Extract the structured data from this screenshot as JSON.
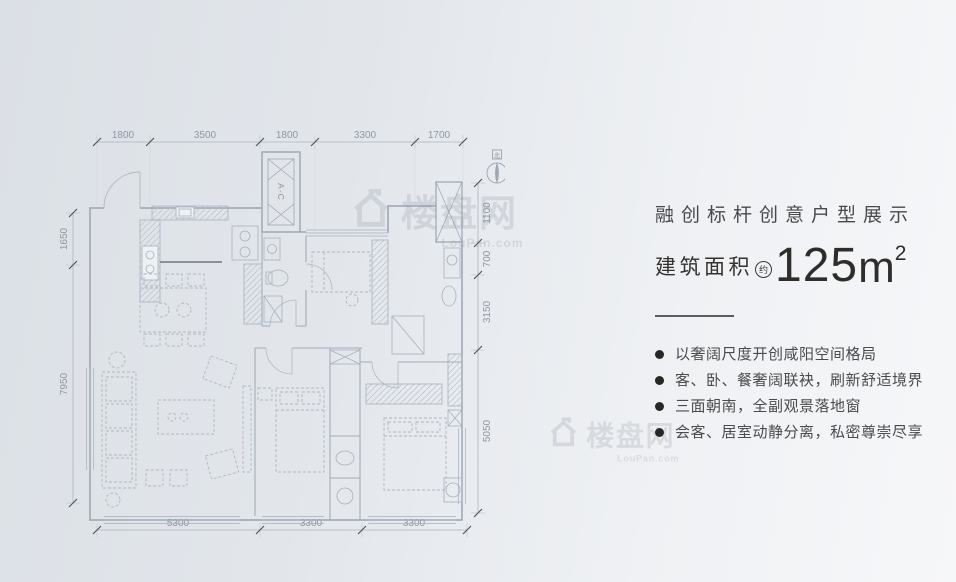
{
  "floorplan": {
    "dims": {
      "top": [
        "1800",
        "3500",
        "1800",
        "3300",
        "1700"
      ],
      "bottom": [
        "5300",
        "3300",
        "3300"
      ],
      "left": [
        "1650",
        "7950"
      ],
      "right": [
        "1100",
        "700",
        "3150",
        "5050"
      ]
    },
    "labels": {
      "ac_unit": "A-C",
      "compass_north": "北"
    },
    "line_color": "#9aa5b2"
  },
  "watermark": {
    "text": "楼盘网",
    "subtext": "LouPan.com"
  },
  "panel": {
    "title": "融创标杆创意户型展示",
    "area": {
      "label": "建筑面积",
      "approx": "约",
      "value": "125",
      "unit": "m",
      "exponent": "2"
    },
    "features": [
      "以奢阔尺度开创咸阳空间格局",
      "客、卧、餐奢阔联袂，刷新舒适境界",
      "三面朝南，全副观景落地窗",
      "会客、居室动静分离，私密尊崇尽享"
    ],
    "text_color": "#474747"
  }
}
